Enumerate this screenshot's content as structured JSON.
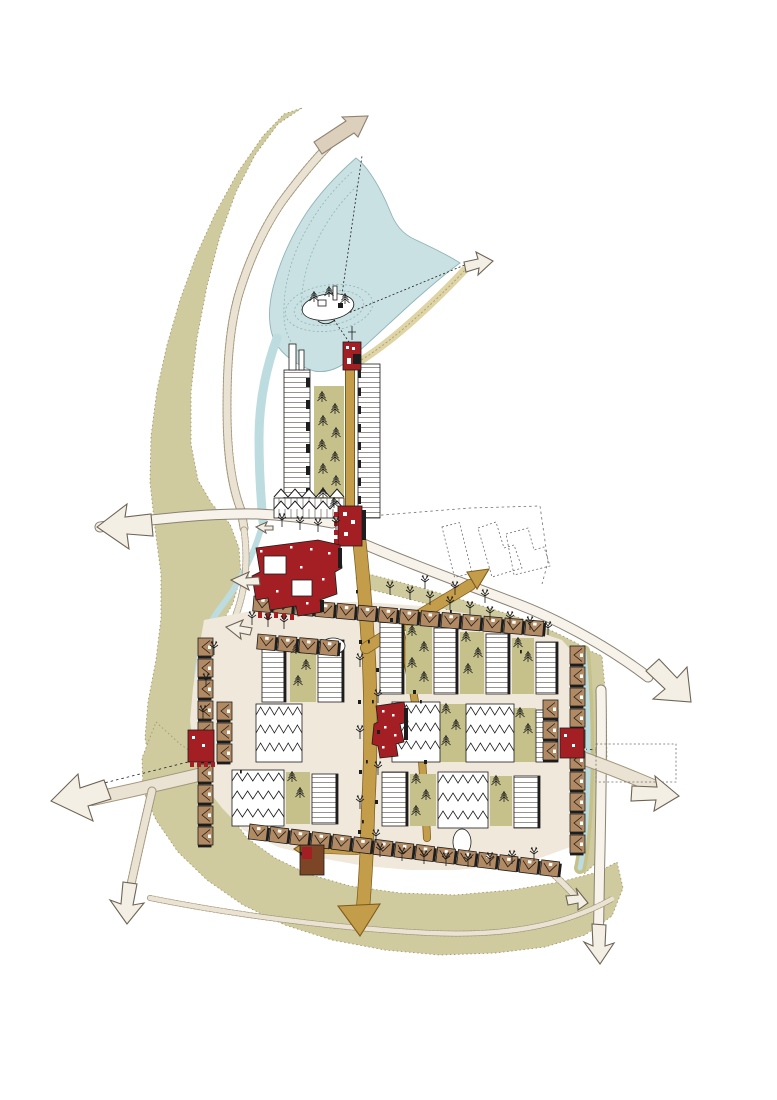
{
  "canvas": {
    "width": 777,
    "height": 1100
  },
  "palette": {
    "paper": "#ffffff",
    "land": "#cfcb9e",
    "land_edge": "#a09a72",
    "lake": "#c9e1e3",
    "water_edge": "#8fb4b8",
    "stream": "#bddce0",
    "beach": "#ded4a4",
    "road": "#eae2d2",
    "road_edge": "#a3967b",
    "white_road": "#f7f3ea",
    "white_road_edge": "#8a8173",
    "arrow_fill": "#f4efe5",
    "arrow_edge": "#6e6455",
    "solid_arrow": "#dccfbc",
    "solid_arrow_edge": "#8d8272",
    "ochre": "#c49d4a",
    "ochre_edge": "#7c5c1e",
    "red": "#a31f24",
    "red_dark": "#6e1013",
    "rust": "#7c4526",
    "brown": "#b18a63",
    "green_court": "#c6c18a",
    "cream": "#efe8db",
    "ink": "#1d1d1d",
    "phantom": "#6f6f6f"
  },
  "features": {
    "lake": "boating lake with wooded island",
    "island": "island with pavilions and trees",
    "sailboat": "dinghy sailing on the lake",
    "beach": "lakeside beach strip",
    "linear_quarter": "tree-lined terrace strip linking lake to village",
    "village": "compact village of terraced housing around courtyards",
    "landmarks": "red civic / landmark buildings",
    "phantom_blocks": "future development plots drawn dashed",
    "view_cone": "dashed sight lines across the lake",
    "routes": "roads, lanes and footpaths ending in direction arrows"
  }
}
